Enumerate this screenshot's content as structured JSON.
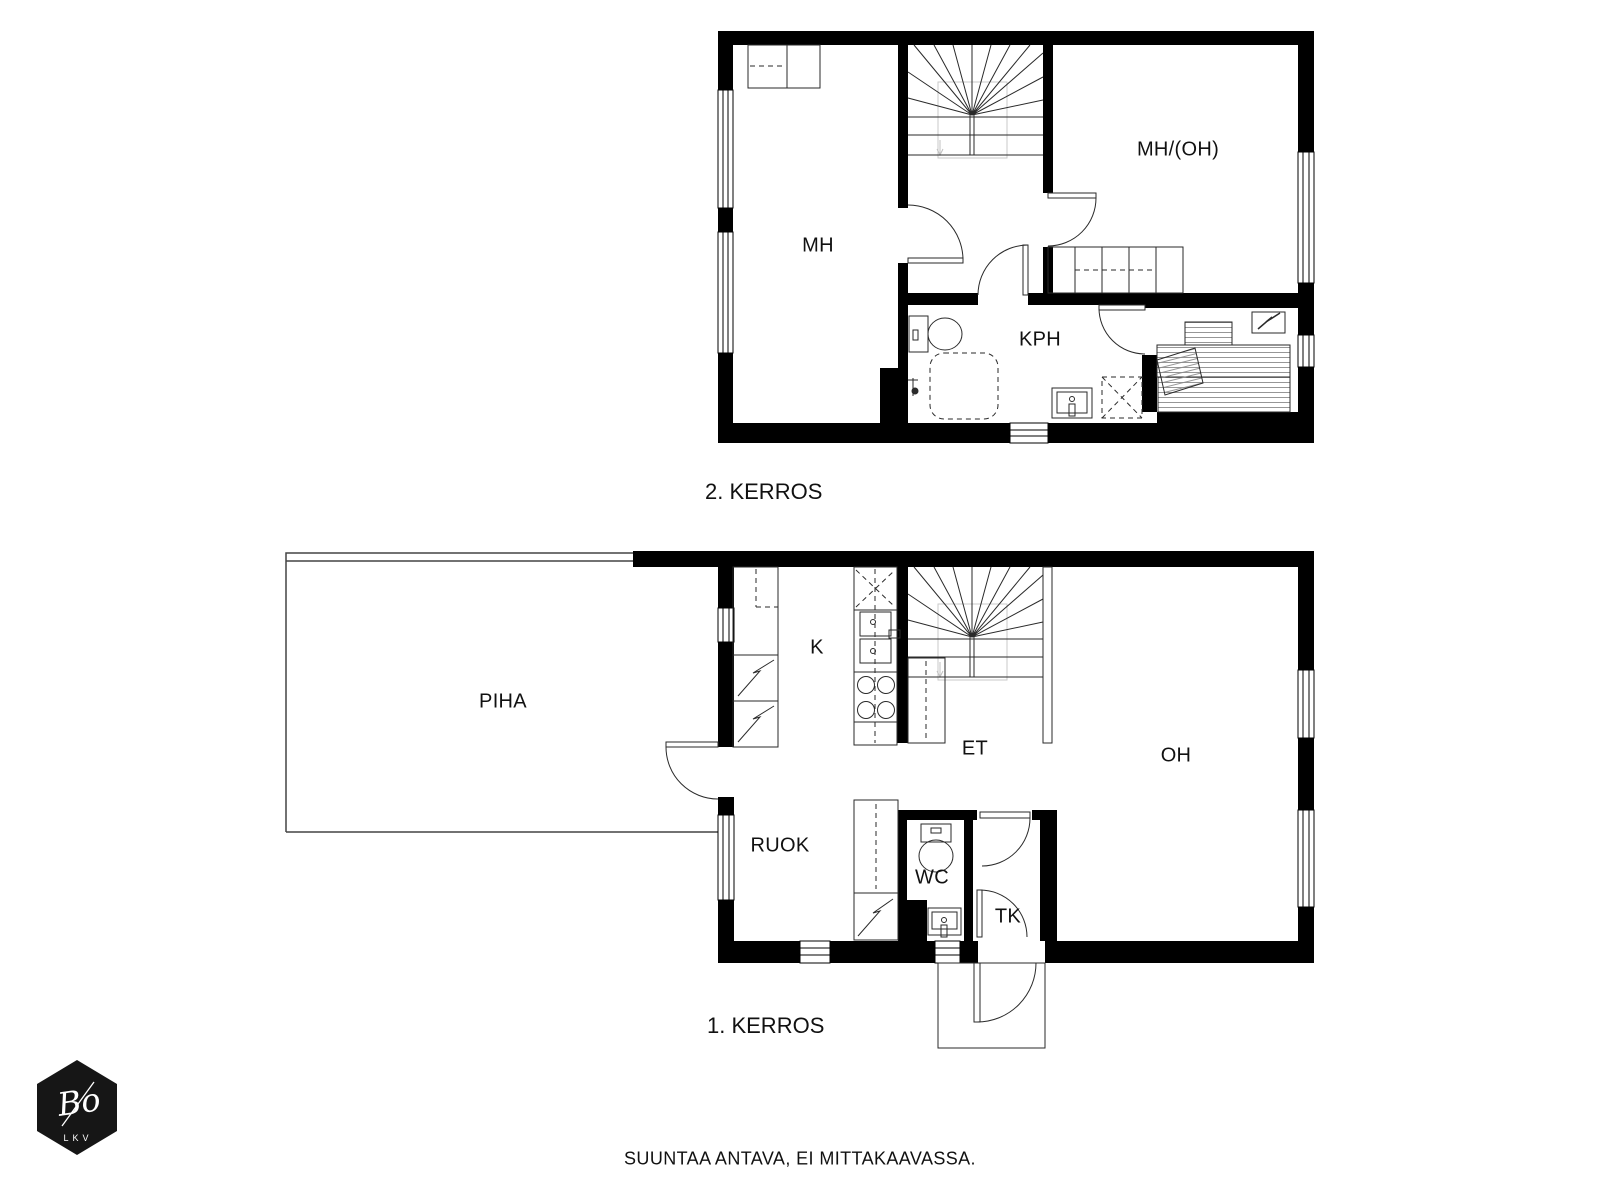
{
  "floor2": {
    "title": "2. KERROS",
    "rooms": {
      "mh": "MH",
      "mh_oh": "MH/(OH)",
      "kph": "KPH"
    }
  },
  "floor1": {
    "title": "1. KERROS",
    "rooms": {
      "piha": "PIHA",
      "k": "K",
      "et": "ET",
      "oh": "OH",
      "ruok": "RUOK",
      "wc": "WC",
      "tk": "TK"
    }
  },
  "footer": {
    "disclaimer": "SUUNTAA ANTAVA, EI MITTAKAAVASSA."
  },
  "logo": {
    "brand": "Bo",
    "sub": "LKV"
  },
  "colors": {
    "wall": "#000000",
    "background": "#ffffff",
    "line": "#2a2a2a"
  }
}
